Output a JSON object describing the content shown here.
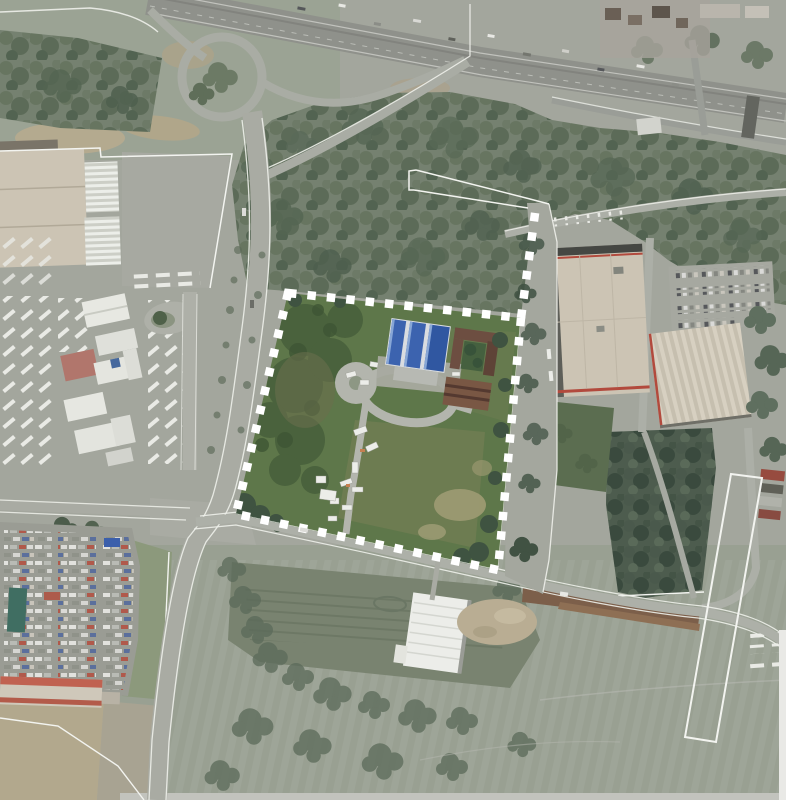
{
  "meta": {
    "type": "aerial-satellite-image",
    "description": "Aerial orthophoto of an industrial / peri-urban area. A rectangular development site with green fields, a blue-roofed hall and a loop driveway is outlined with a white dashed (checkered) cadastral boundary. A motorway with a cloverleaf interchange crosses the top, warehouses flank the site left and right, a car storage lot sits bottom-left.",
    "width_px": 786,
    "height_px": 800,
    "visible_text": []
  },
  "boundary": {
    "name": "site-parcel-boundary",
    "corners": [
      [
        288,
        293
      ],
      [
        521,
        318
      ],
      [
        498,
        570
      ],
      [
        236,
        514
      ]
    ],
    "tail": [
      [
        521,
        318
      ],
      [
        536,
        206
      ]
    ],
    "stroke_width": 8.5,
    "dash": "8.5 11",
    "color": "#ffffff"
  },
  "colors": {
    "base": "#a3a69d",
    "field_dark": "#79836f",
    "field_beige": "#b2a88c",
    "forest": "#75816f",
    "forest_dark": "#4f5f50",
    "tree_deep": "#3e5340",
    "road": "#a9aba3",
    "highway": "#8f918b",
    "white_line": "#f3f4f0",
    "boundary_white": "#ffffff",
    "parcel_green": "#5d7748",
    "parcel_dark": "#49623c",
    "parcel_olive": "#6d7c4f",
    "parcel_pale": "#9c9a70",
    "drive_gray": "#b3b5ad",
    "blue_roof": "#3a63b2",
    "blue_roof_light": "#86a6d8",
    "brown_roof": "#6e4e40",
    "warehouse_beige": "#ccc4b3",
    "dark_edge": "#454743",
    "red_trim": "#b5493c",
    "lawn": "#5a6d4f",
    "vehicle_white": "#ecede9",
    "car_lot": "#9a9c94",
    "teal_roof": "#3f6e62",
    "red_roof_building": "#c3614f",
    "dirt": "#7d5f49",
    "rubble": "#b9ad92",
    "grass_strip": "#8c997b"
  },
  "features": [
    {
      "name": "motorway",
      "label": "multi-lane highway, top edge"
    },
    {
      "name": "interchange-loop",
      "label": "cloverleaf loop ramp, top left"
    },
    {
      "name": "site-parcel",
      "label": "development site with dashed white boundary"
    },
    {
      "name": "blue-roof-building",
      "label": "blue industrial hall inside site"
    },
    {
      "name": "loop-driveway",
      "label": "oval driveway inside site"
    },
    {
      "name": "left-industrial-area",
      "label": "warehouses and truck yards, left"
    },
    {
      "name": "right-warehouse-area",
      "label": "two large warehouses and car park, right"
    },
    {
      "name": "car-lot",
      "label": "dense vehicle storage lot, bottom left"
    },
    {
      "name": "white-warehouse",
      "label": "white hall, bottom centre"
    },
    {
      "name": "narrow-strip-outline",
      "label": "thin white cadastral strip, bottom right"
    }
  ]
}
